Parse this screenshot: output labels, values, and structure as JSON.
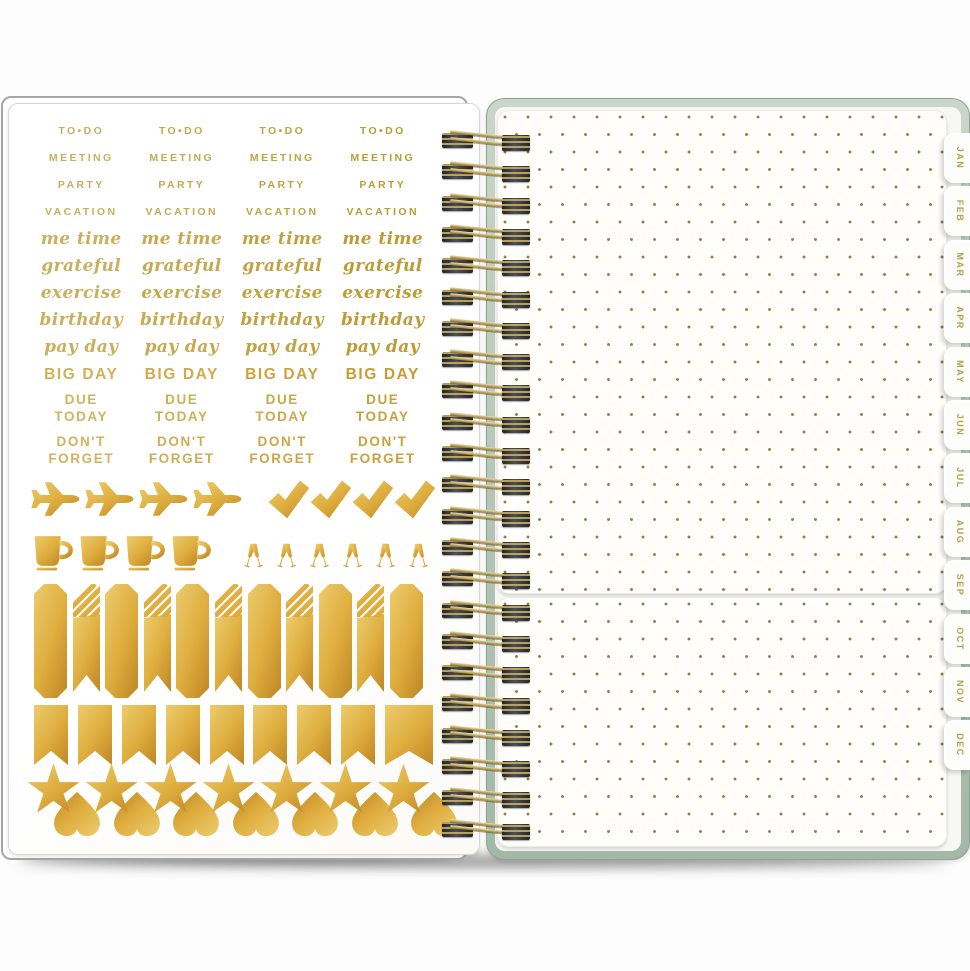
{
  "scene": {
    "description": "Open spiral-bound planner: gold foil sticker sheet on left page, gold-dotted pocket pages with monthly tabs on right"
  },
  "sticker_sheet": {
    "columns": 4,
    "text_rows": [
      {
        "label": "TO•DO",
        "style": "caps"
      },
      {
        "label": "MEETING",
        "style": "caps"
      },
      {
        "label": "PARTY",
        "style": "caps"
      },
      {
        "label": "VACATION",
        "style": "caps"
      },
      {
        "label": "me time",
        "style": "script"
      },
      {
        "label": "grateful",
        "style": "script"
      },
      {
        "label": "exercise",
        "style": "script"
      },
      {
        "label": "birthday",
        "style": "script"
      },
      {
        "label": "pay day",
        "style": "script"
      },
      {
        "label": "BIG DAY",
        "style": "big"
      },
      {
        "label": "DUE\nTODAY",
        "style": "bold2"
      },
      {
        "label": "DON'T\nFORGET",
        "style": "bold2"
      }
    ],
    "icon_rows": [
      {
        "icons": [
          "airplane",
          "airplane",
          "airplane",
          "airplane",
          "checkmark",
          "checkmark",
          "checkmark",
          "checkmark"
        ]
      },
      {
        "icons": [
          "coffee-mug",
          "coffee-mug",
          "coffee-mug",
          "coffee-mug",
          "champagne-toast",
          "champagne-toast",
          "champagne-toast",
          "champagne-toast",
          "champagne-toast",
          "champagne-toast"
        ]
      },
      {
        "icons": [
          "label-strip",
          "striped-ribbon",
          "label-strip",
          "striped-ribbon",
          "label-strip",
          "striped-ribbon",
          "label-strip",
          "striped-ribbon",
          "label-strip",
          "striped-ribbon",
          "label-strip"
        ]
      },
      {
        "icons": [
          "pennant",
          "pennant",
          "pennant",
          "pennant",
          "pennant",
          "pennant",
          "pennant",
          "pennant",
          "pennant-wide"
        ]
      },
      {
        "icons": [
          "star",
          "star",
          "star",
          "star",
          "star",
          "star",
          "star"
        ]
      },
      {
        "icons": [
          "heart",
          "heart",
          "heart",
          "heart",
          "heart",
          "heart",
          "heart"
        ]
      }
    ]
  },
  "binding": {
    "loop_count": 23
  },
  "tabs": {
    "items": [
      {
        "label": "JAN"
      },
      {
        "label": "FEB"
      },
      {
        "label": "MAR"
      },
      {
        "label": "APR"
      },
      {
        "label": "MAY"
      },
      {
        "label": "JUN"
      },
      {
        "label": "JUL"
      },
      {
        "label": "AUG"
      },
      {
        "label": "SEP"
      },
      {
        "label": "OCT"
      },
      {
        "label": "NOV"
      },
      {
        "label": "DEC"
      }
    ]
  },
  "colors": {
    "gold_foil_light": "#ecca68",
    "gold_foil_dark": "#c08c28",
    "gold_text": "#c2a648",
    "sage_cover": "#b5c8b6",
    "dot": "#8f7f40",
    "page_white": "#ffffff"
  }
}
